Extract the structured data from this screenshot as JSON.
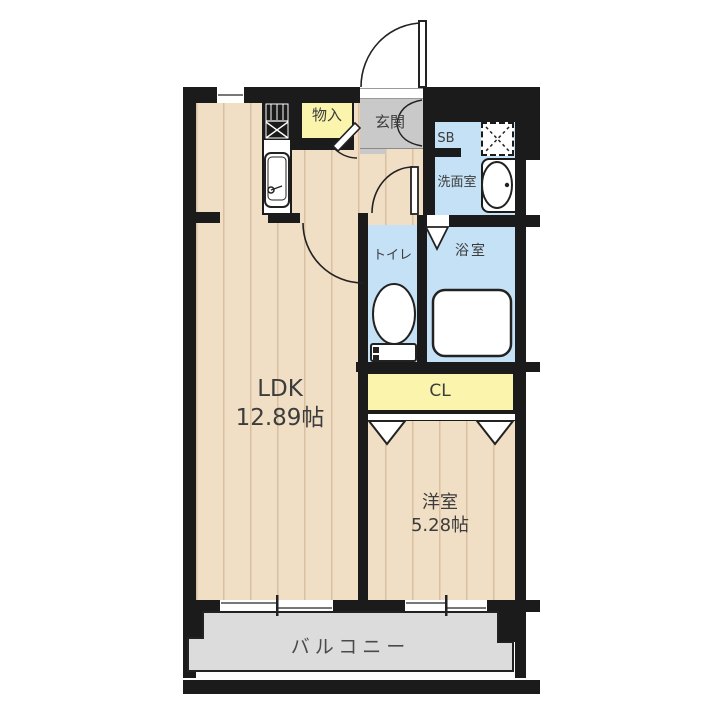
{
  "floorplan": {
    "rooms": {
      "ldk": {
        "label": "LDK",
        "size": "12.89帖"
      },
      "western_room": {
        "label": "洋室",
        "size": "5.28帖"
      },
      "balcony": {
        "label": "バルコニー"
      },
      "entrance": {
        "label": "玄関"
      },
      "storage": {
        "label": "物入"
      },
      "shoe_box": {
        "label": "SB"
      },
      "washroom": {
        "label": "洗面室"
      },
      "toilet": {
        "label": "トイレ"
      },
      "bathroom": {
        "label": "浴室"
      },
      "closet": {
        "label": "CL"
      }
    },
    "fixtures": {
      "kitchen_stove": "gas-stove-icon",
      "kitchen_sink": "kitchen-sink-icon",
      "wash_basin": "wash-basin-icon",
      "washing_machine_space": "washing-machine-pan-icon",
      "toilet_bowl": "toilet-icon",
      "bathtub": "bathtub-icon"
    },
    "colors": {
      "wall": "#1b1b1b",
      "floor": "#F0DEC5",
      "floor_stripe": "#C4A37D",
      "wet_room_blue": "#C4E1F6",
      "storage_yellow": "#FAF4AC",
      "entrance_gray": "#C9C9C9",
      "balcony_gray": "#DCDCDC",
      "label_text": "#3C3C3C"
    }
  }
}
